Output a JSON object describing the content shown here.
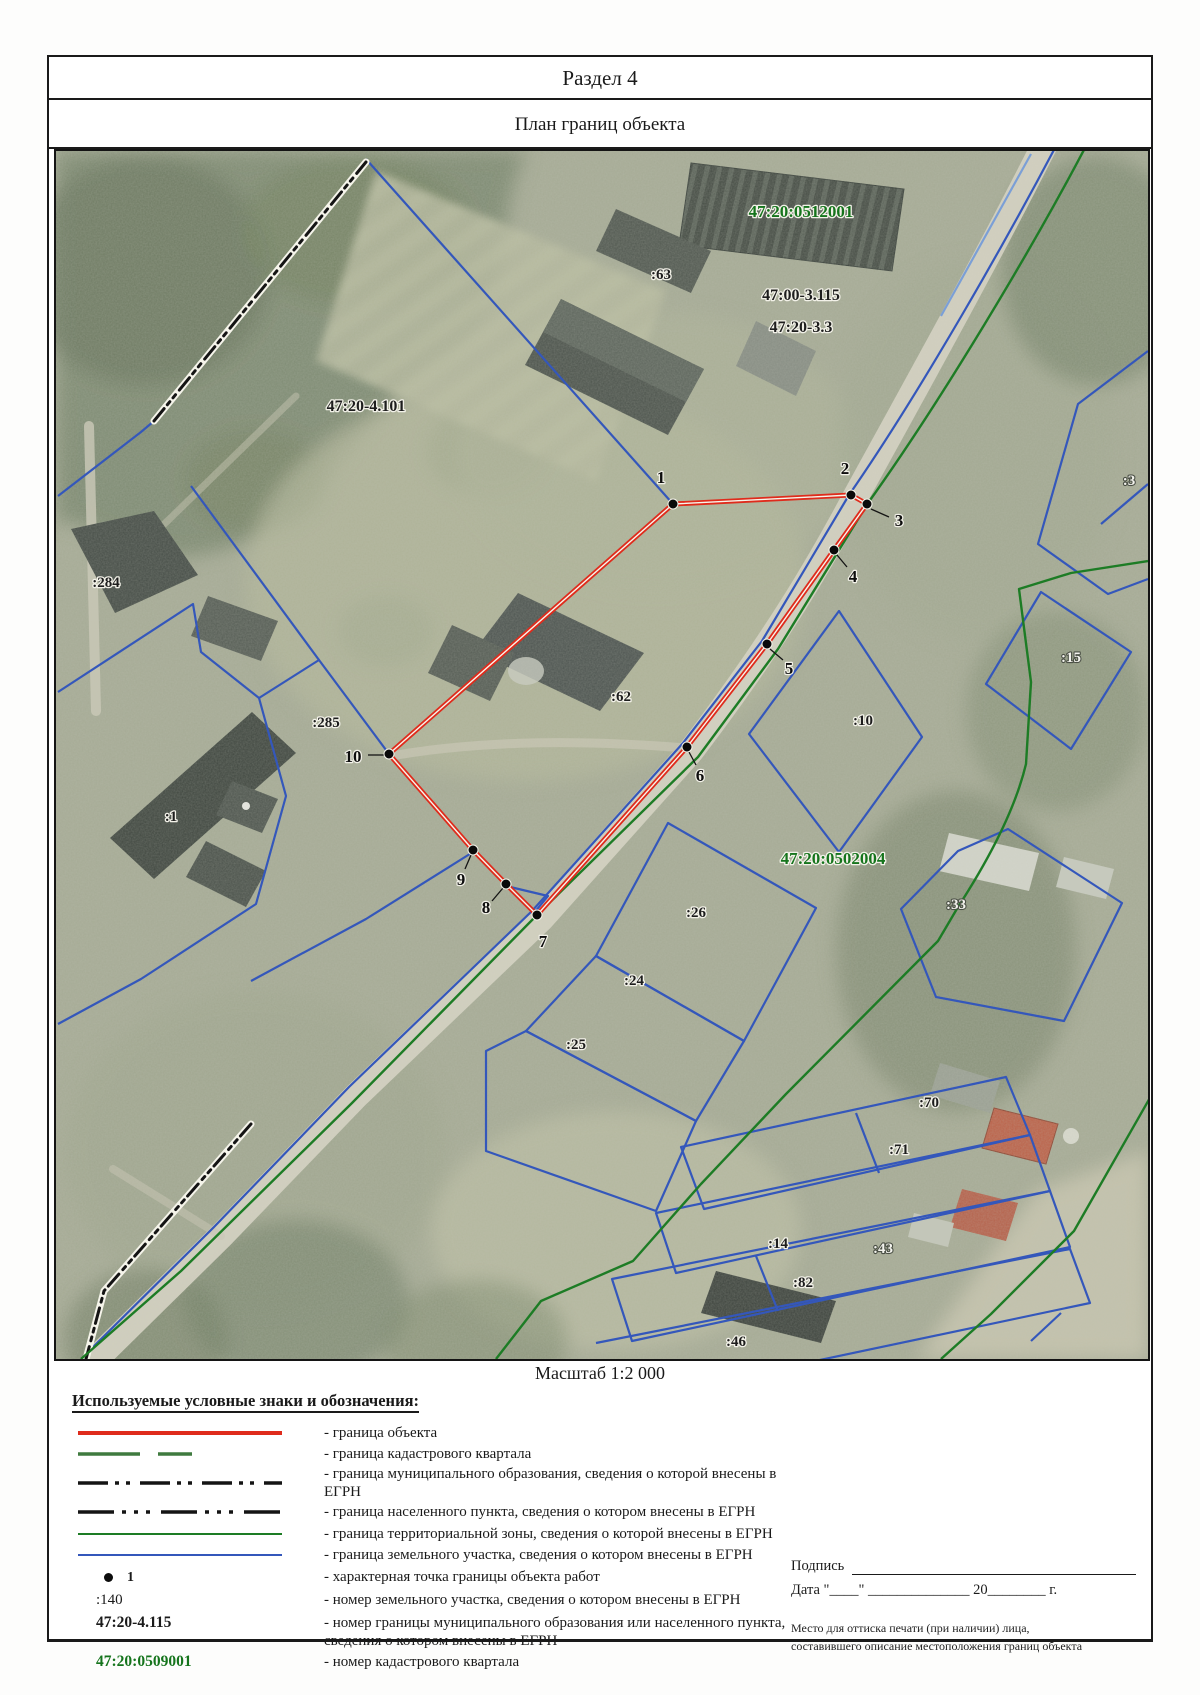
{
  "page": {
    "section_title": "Раздел 4",
    "subtitle": "План границ объекта",
    "scale_label": "Масштаб 1:2 000"
  },
  "map": {
    "points": [
      "1",
      "2",
      "3",
      "4",
      "5",
      "6",
      "7",
      "8",
      "9",
      "10"
    ],
    "labels": {
      "quarter_0512001": "47:20:0512001",
      "parcel_63": ":63",
      "boundary_47_00_3_115": "47:00-3.115",
      "boundary_47_20_3_3": "47:20-3.3",
      "boundary_47_20_4_101": "47:20-4.101",
      "parcel_3": ":3",
      "parcel_284": ":284",
      "parcel_15": ":15",
      "parcel_62": ":62",
      "parcel_285": ":285",
      "parcel_10": ":10",
      "parcel_1": ":1",
      "quarter_0502004": "47:20:0502004",
      "parcel_26": ":26",
      "parcel_24": ":24",
      "parcel_25": ":25",
      "parcel_33": ":33",
      "parcel_70": ":70",
      "parcel_71": ":71",
      "parcel_14": ":14",
      "parcel_43": ":43",
      "parcel_82": ":82",
      "parcel_46": ":46"
    }
  },
  "legend": {
    "title": "Используемые условные знаки и обозначения:",
    "items": [
      {
        "symbol": "object-boundary-line",
        "label": "- граница объекта"
      },
      {
        "symbol": "cadastral-quarter-line",
        "label": "- граница кадастрового квартала"
      },
      {
        "symbol": "municipal-boundary-line",
        "label": "- граница муниципального образования, сведения о которой внесены в ЕГРН"
      },
      {
        "symbol": "settlement-boundary-line",
        "label": "- граница населенного пункта, сведения о котором внесены в ЕГРН"
      },
      {
        "symbol": "territorial-zone-line",
        "label": "- граница территориальной зоны, сведения о которой внесены в ЕГРН"
      },
      {
        "symbol": "parcel-boundary-line",
        "label": "- граница земельного участка, сведения о котором внесены в ЕГРН"
      },
      {
        "symbol": "characteristic-point-dot",
        "sample": "1",
        "label": "- характерная точка границы объекта работ"
      },
      {
        "symbol": "parcel-number",
        "sample": ":140",
        "label": "- номер земельного участка, сведения о котором внесены в ЕГРН"
      },
      {
        "symbol": "boundary-number",
        "sample": "47:20-4.115",
        "label": "- номер границы муниципального образования или населенного пункта, сведения о котором внесены в ЕГРН"
      },
      {
        "symbol": "quarter-number",
        "sample": "47:20:0509001",
        "label": "- номер кадастрового квартала"
      }
    ]
  },
  "signature": {
    "signature_label": "Подпись",
    "date_line": "Дата \"____\" ______________ 20________ г.",
    "stamp_line1": "Место для оттиска печати (при наличии) лица,",
    "stamp_line2": "составившего описание местоположения границ объекта"
  },
  "colors": {
    "object_boundary_red": "#df2b1c",
    "cadastral_quarter_green": "#3f7a3f",
    "municipal_boundary_black": "#1a1a1a",
    "territorial_zone_green": "#1d7c25",
    "parcel_boundary_blue": "#3457bb",
    "quarter_number_green": "#15741c"
  }
}
